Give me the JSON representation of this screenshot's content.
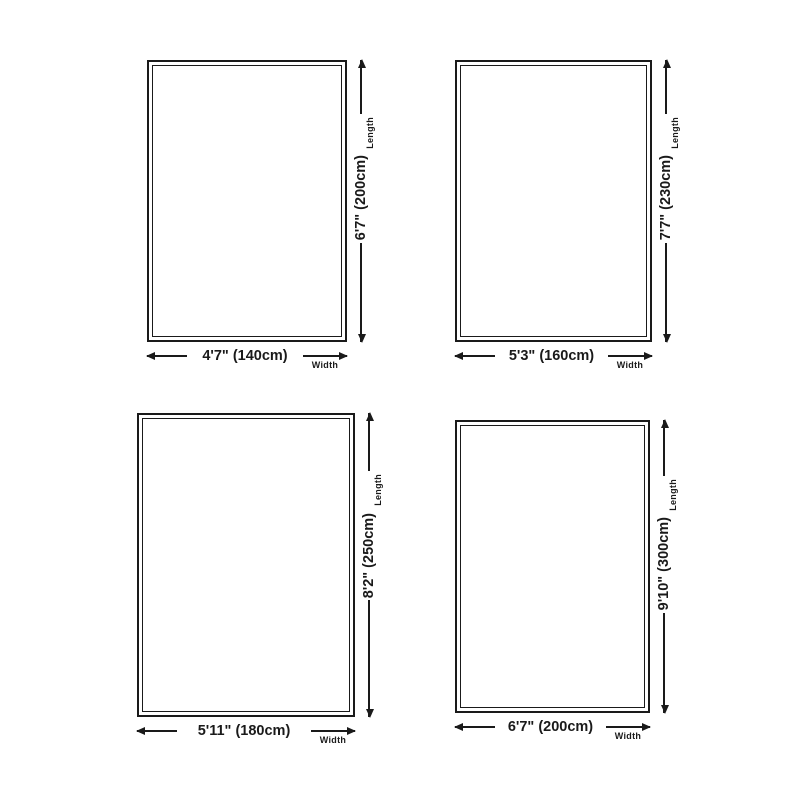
{
  "colors": {
    "ink": "#1a1a1a",
    "background": "#ffffff"
  },
  "captions": {
    "width": "Width",
    "length": "Length"
  },
  "rugs": [
    {
      "width_label": "4'7\" (140cm)",
      "length_label": "6'7\" (200cm)"
    },
    {
      "width_label": "5'3\" (160cm)",
      "length_label": "7'7\" (230cm)"
    },
    {
      "width_label": "5'11\" (180cm)",
      "length_label": "8'2\" (250cm)"
    },
    {
      "width_label": "6'7\" (200cm)",
      "length_label": "9'10\" (300cm)"
    }
  ]
}
